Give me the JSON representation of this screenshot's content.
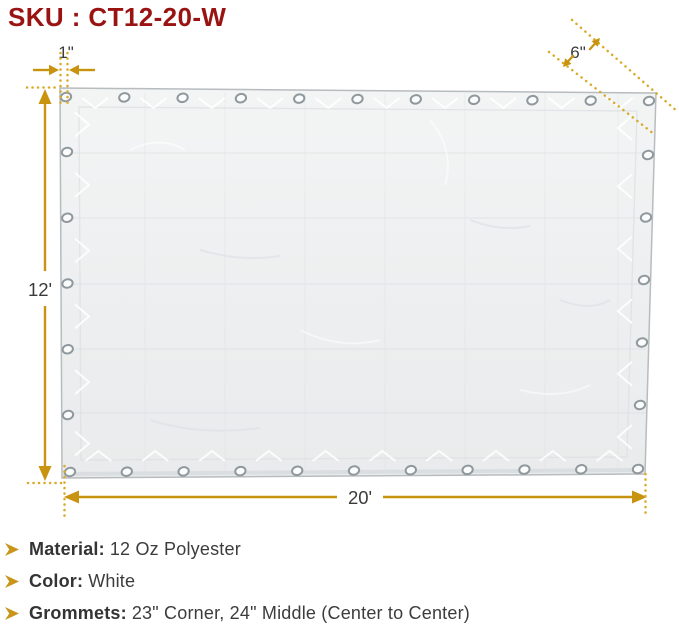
{
  "title": "SKU : CT12-20-W",
  "colors": {
    "accent_gold": "#C9951A",
    "dotted_gold": "#D8AB2A",
    "title_red": "#9A1313",
    "text_dark": "#3C3C3C",
    "tarp_white": "#EFF1F2",
    "grommet_ring": "#8F989D"
  },
  "diagram": {
    "labels": {
      "hem_width": "1\"",
      "corner_spacing": "6\"",
      "height": "12'",
      "width": "20'"
    },
    "grommets": {
      "top": 11,
      "bottom": 11,
      "left_middle": 5,
      "right_middle": 5
    }
  },
  "specs": [
    {
      "label": "Material:",
      "value": "12 Oz Polyester"
    },
    {
      "label": "Color:",
      "value": "White"
    },
    {
      "label": "Grommets:",
      "value": "23\" Corner, 24\" Middle (Center to Center)"
    }
  ]
}
